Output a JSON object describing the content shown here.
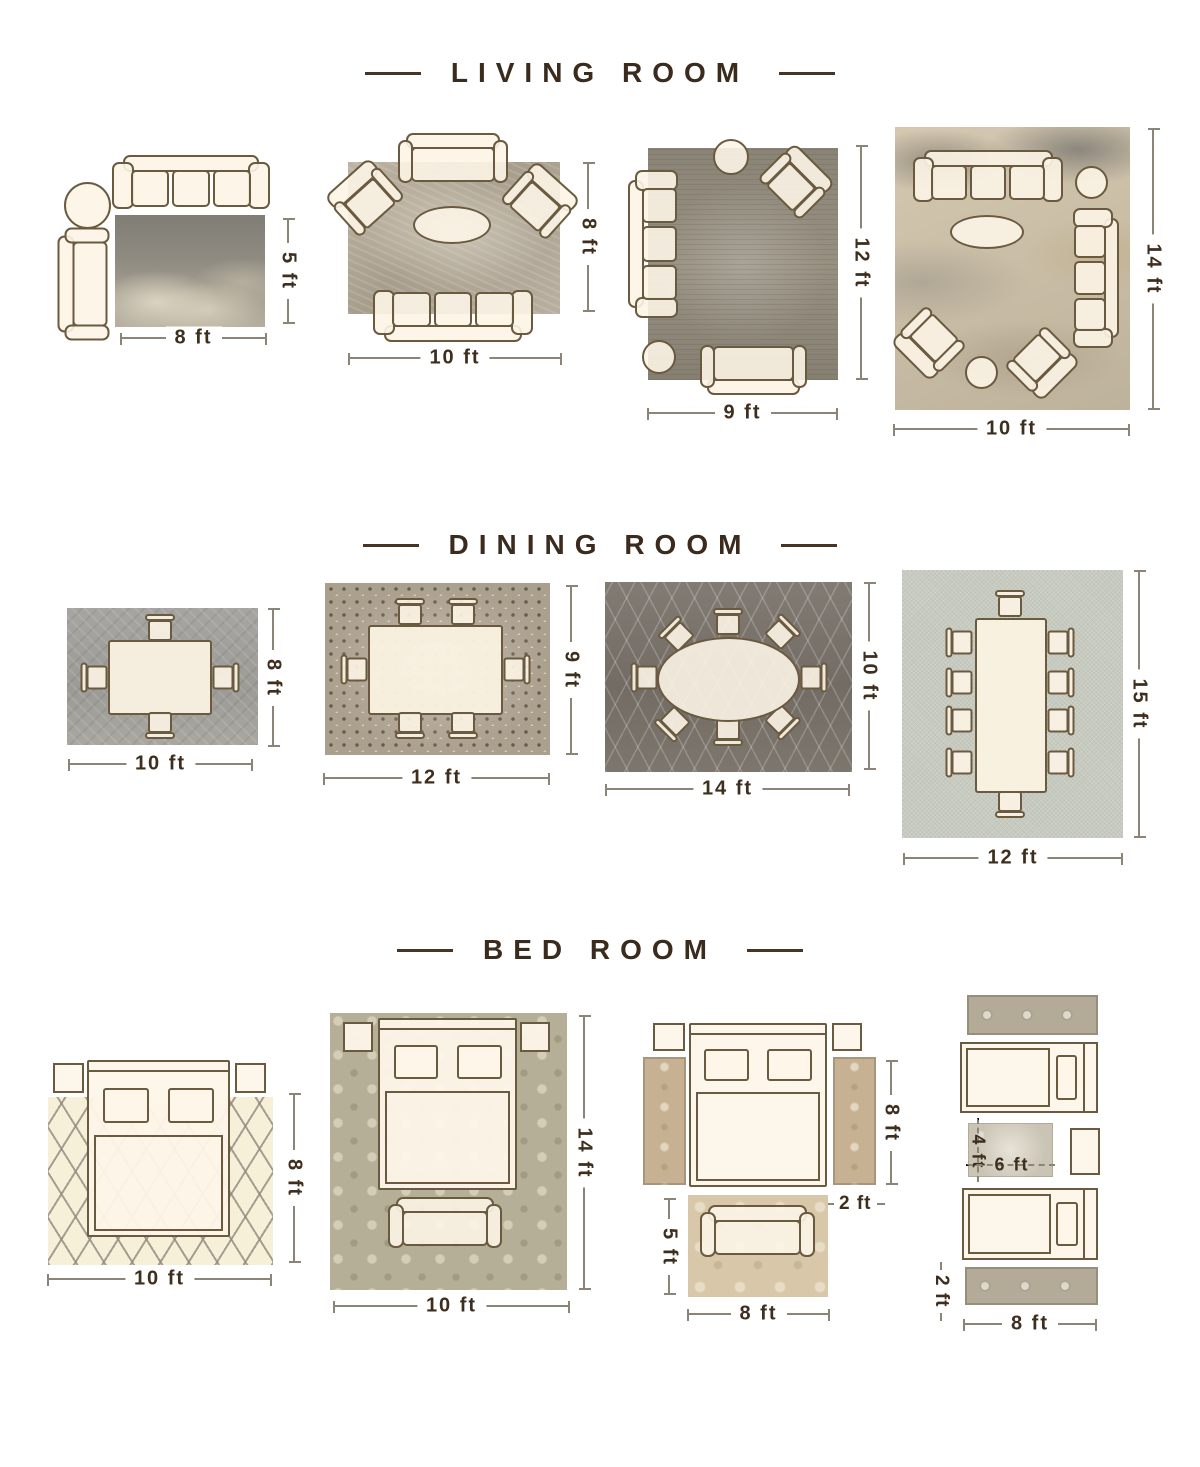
{
  "colors": {
    "background": "#ffffff",
    "heading_text": "#3a2b1d",
    "dimension_text": "#3e2e1d",
    "dimension_line": "#8d8478",
    "furniture_fill": "#fcf4e5",
    "furniture_outline": "#6a5a3f",
    "rugs": {
      "living_1": "#9a968c",
      "living_2": "#b5ab9b",
      "living_3": "#8f8a7c",
      "living_4": "#c9bca6",
      "dining_1": "#a2a19c",
      "dining_2": "#ab9f8d",
      "dining_3": "#767068",
      "dining_4": "#c7cabf",
      "bed_1": "#f7f0d8",
      "bed_2": "#b6af97",
      "bed_3_runner": "#c6b192",
      "bed_3_foot": "#d8c7a8",
      "bed_4_runner": "#b3ab97",
      "bed_4_accent": "#c9c4b4"
    }
  },
  "sections": [
    {
      "title": "LIVING ROOM",
      "layouts": [
        {
          "bottom_label": "8 ft",
          "side_label": "5 ft"
        },
        {
          "bottom_label": "10 ft",
          "side_label": "8 ft"
        },
        {
          "bottom_label": "9 ft",
          "side_label": "12 ft"
        },
        {
          "bottom_label": "10 ft",
          "side_label": "14 ft"
        }
      ]
    },
    {
      "title": "DINING ROOM",
      "layouts": [
        {
          "bottom_label": "10 ft",
          "side_label": "8 ft"
        },
        {
          "bottom_label": "12 ft",
          "side_label": "9 ft"
        },
        {
          "bottom_label": "14 ft",
          "side_label": "10 ft"
        },
        {
          "bottom_label": "12 ft",
          "side_label": "15 ft"
        }
      ]
    },
    {
      "title": "BED ROOM",
      "layouts": [
        {
          "bottom_label": "10 ft",
          "side_label": "8 ft"
        },
        {
          "bottom_label": "10 ft",
          "side_label": "14 ft"
        },
        {
          "bottom_label": "8 ft",
          "side_label": "8 ft",
          "runner_width_label": "2 ft",
          "foot_rug_height_label": "5 ft"
        },
        {
          "bottom_label": "8 ft",
          "accent_height_label": "4 ft",
          "accent_width_label": "6 ft",
          "runner_height_label": "2 ft"
        }
      ]
    }
  ]
}
